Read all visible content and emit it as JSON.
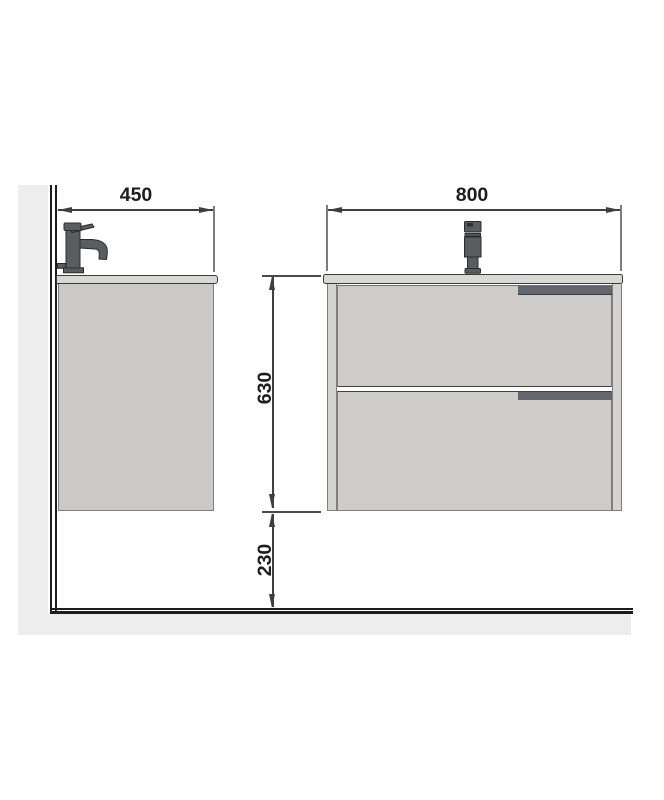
{
  "page": {
    "background": "#ffffff",
    "description_domain": "technical installation drawing of wall-hung vanity unit"
  },
  "dimensions": {
    "side_width": "450",
    "front_width": "800",
    "unit_height": "630",
    "floor_clearance": "230"
  },
  "colors": {
    "wall_floor_fill": "#ededed",
    "structure_line": "#1c1c1c",
    "outline": "#3f3f3f",
    "counter_fill": "#d8d8d7",
    "cabinet_fill": "#cac9c8",
    "drawer_fill": "#cdcccb",
    "handle_fill": "#63666a",
    "faucet_fill": "#5a5d5f",
    "dimension_text": "#1d1d1d"
  },
  "icons": {
    "faucet_side": "faucet-side-icon",
    "faucet_front": "faucet-front-icon"
  }
}
